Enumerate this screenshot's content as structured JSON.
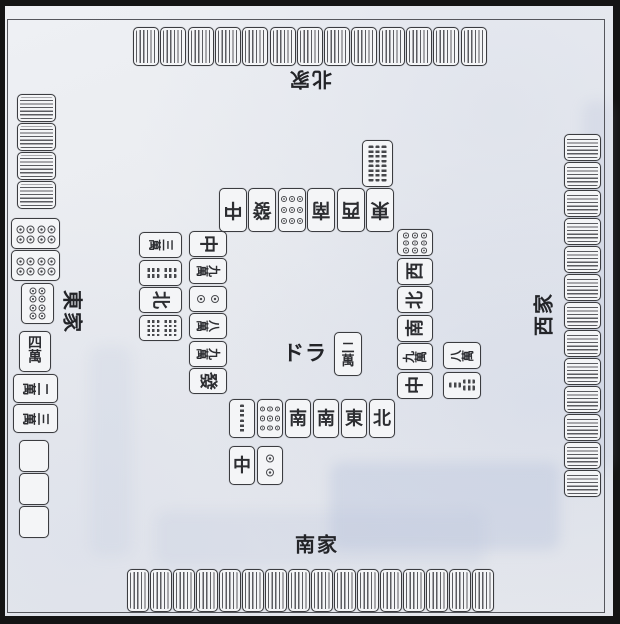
{
  "labels": {
    "north": "北家",
    "south": "南家",
    "east": "東家",
    "west": "西家",
    "dora": "ドラ"
  },
  "colors": {
    "paper": "#e9ebef",
    "tile_face": "#f4f5f7",
    "line": "#3b3c40",
    "border": "#141414"
  },
  "tile_groups": [
    {
      "id": "north-wall",
      "repeat": {
        "k": "back",
        "stripes": "v",
        "name": "back"
      },
      "count": 13
    },
    {
      "id": "south-wall",
      "repeat": {
        "k": "back",
        "stripes": "v",
        "name": "back"
      },
      "count": 16
    },
    {
      "id": "west-wall",
      "repeat": {
        "k": "back",
        "stripes": "h",
        "name": "back"
      },
      "count": 13
    },
    {
      "id": "east-wall",
      "repeat": {
        "k": "back",
        "stripes": "h",
        "name": "back"
      },
      "count": 4
    },
    {
      "id": "east-meld",
      "tiles": [
        {
          "k": "pin",
          "n": 8,
          "rows": [
            2,
            2,
            2,
            2
          ],
          "name": "8-pin"
        },
        {
          "k": "pin",
          "n": 8,
          "rows": [
            2,
            2,
            2,
            2
          ],
          "name": "8-pin"
        },
        {
          "k": "pin",
          "n": 8,
          "rows": [
            2,
            2,
            2,
            2
          ],
          "name": "8-pin"
        }
      ]
    },
    {
      "id": "east-hand",
      "tiles": [
        {
          "k": "man",
          "v": "四萬",
          "name": "4-man"
        },
        {
          "k": "man",
          "v": "二萬",
          "name": "2-man"
        },
        {
          "k": "man",
          "v": "三萬",
          "name": "3-man"
        }
      ]
    },
    {
      "id": "east-blanks",
      "repeat": {
        "k": "blank",
        "name": "blank"
      },
      "count": 3
    },
    {
      "id": "east-discards-outer",
      "tiles": [
        {
          "k": "man",
          "v": "三萬",
          "name": "3-man"
        },
        {
          "k": "sou",
          "n": 4,
          "rows": [
            2,
            2
          ],
          "name": "4-sou"
        },
        {
          "k": "char",
          "v": "北",
          "name": "north-wind"
        },
        {
          "k": "sou",
          "n": 8,
          "rows": [
            4,
            4
          ],
          "name": "8-sou"
        }
      ]
    },
    {
      "id": "east-discards-inner",
      "tiles": [
        {
          "k": "char",
          "v": "中",
          "name": "chun"
        },
        {
          "k": "man",
          "v": "九萬",
          "name": "9-man"
        },
        {
          "k": "pin",
          "n": 2,
          "rows": [
            1,
            1
          ],
          "name": "2-pin"
        },
        {
          "k": "man",
          "v": "八萬",
          "name": "8-man"
        },
        {
          "k": "man",
          "v": "九萬",
          "name": "9-man"
        },
        {
          "k": "char",
          "v": "發",
          "name": "hatsu"
        }
      ]
    },
    {
      "id": "north-discards",
      "tiles": [
        {
          "k": "char",
          "v": "中",
          "name": "chun"
        },
        {
          "k": "char",
          "v": "發",
          "name": "hatsu"
        },
        {
          "k": "pin",
          "n": 9,
          "rows": [
            3,
            3,
            3
          ],
          "name": "9-pin"
        },
        {
          "k": "char",
          "v": "南",
          "name": "south-wind"
        },
        {
          "k": "char",
          "v": "西",
          "name": "west-wind"
        },
        {
          "k": "char",
          "v": "東",
          "name": "east-wind"
        }
      ]
    },
    {
      "id": "north-extra",
      "tiles": [
        {
          "k": "sou",
          "n": 6,
          "rows": [
            3,
            3
          ],
          "name": "6-sou"
        }
      ]
    },
    {
      "id": "west-discards-inner",
      "tiles": [
        {
          "k": "pin",
          "n": 9,
          "rows": [
            3,
            3,
            3
          ],
          "name": "9-pin"
        },
        {
          "k": "char",
          "v": "西",
          "name": "west-wind"
        },
        {
          "k": "char",
          "v": "北",
          "name": "north-wind"
        },
        {
          "k": "char",
          "v": "南",
          "name": "south-wind"
        },
        {
          "k": "man",
          "v": "九萬",
          "name": "9-man"
        },
        {
          "k": "char",
          "v": "中",
          "name": "chun"
        }
      ]
    },
    {
      "id": "west-discards-outer",
      "tiles": [
        {
          "k": "man",
          "v": "八萬",
          "name": "8-man"
        },
        {
          "k": "sou",
          "n": 3,
          "rows": [
            1,
            2
          ],
          "name": "3-sou"
        }
      ]
    },
    {
      "id": "dora-indicator",
      "tiles": [
        {
          "k": "man",
          "v": "二萬",
          "name": "2-man"
        }
      ]
    },
    {
      "id": "south-discards-row1",
      "tiles": [
        {
          "k": "sou",
          "n": 2,
          "rows": [
            1,
            1
          ],
          "name": "2-sou"
        },
        {
          "k": "pin",
          "n": 9,
          "rows": [
            3,
            3,
            3
          ],
          "name": "9-pin"
        },
        {
          "k": "char",
          "v": "南",
          "name": "south-wind"
        },
        {
          "k": "char",
          "v": "南",
          "name": "south-wind"
        },
        {
          "k": "char",
          "v": "東",
          "name": "east-wind"
        },
        {
          "k": "char",
          "v": "北",
          "name": "north-wind"
        }
      ]
    },
    {
      "id": "south-discards-row2",
      "tiles": [
        {
          "k": "char",
          "v": "中",
          "name": "chun"
        },
        {
          "k": "pin",
          "n": 2,
          "rows": [
            1,
            1
          ],
          "name": "2-pin"
        }
      ]
    }
  ]
}
